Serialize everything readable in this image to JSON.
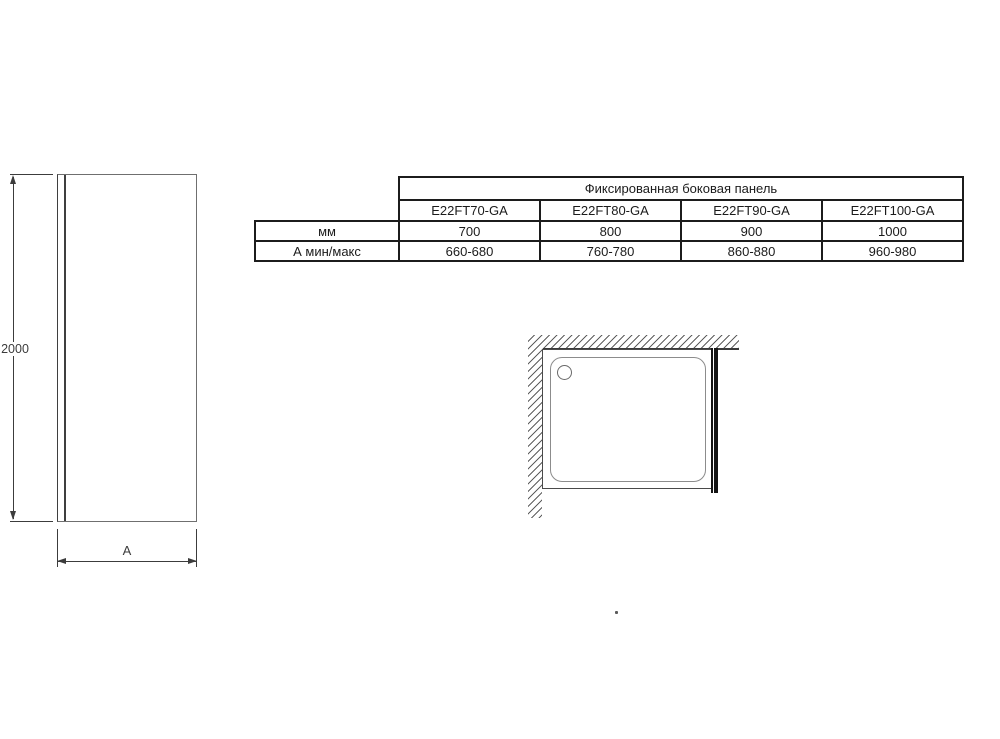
{
  "spec_table": {
    "header": "Фиксированная боковая панель",
    "models": [
      "E22FT70-GA",
      "E22FT80-GA",
      "E22FT90-GA",
      "E22FT100-GA"
    ],
    "rows": [
      {
        "label": "мм",
        "values": [
          "700",
          "800",
          "900",
          "1000"
        ]
      },
      {
        "label": "А мин/макс",
        "values": [
          "660-680",
          "760-780",
          "860-880",
          "960-980"
        ]
      }
    ]
  },
  "elevation": {
    "height_dim": "2000",
    "width_dim": "A"
  },
  "colors": {
    "background": "#ffffff",
    "drawing_line": "#3c3c3c",
    "table_border": "#1c1c1c",
    "text": "#1b1b1b",
    "hatch": "#5f5f5f",
    "panel_fill": "#141414"
  }
}
